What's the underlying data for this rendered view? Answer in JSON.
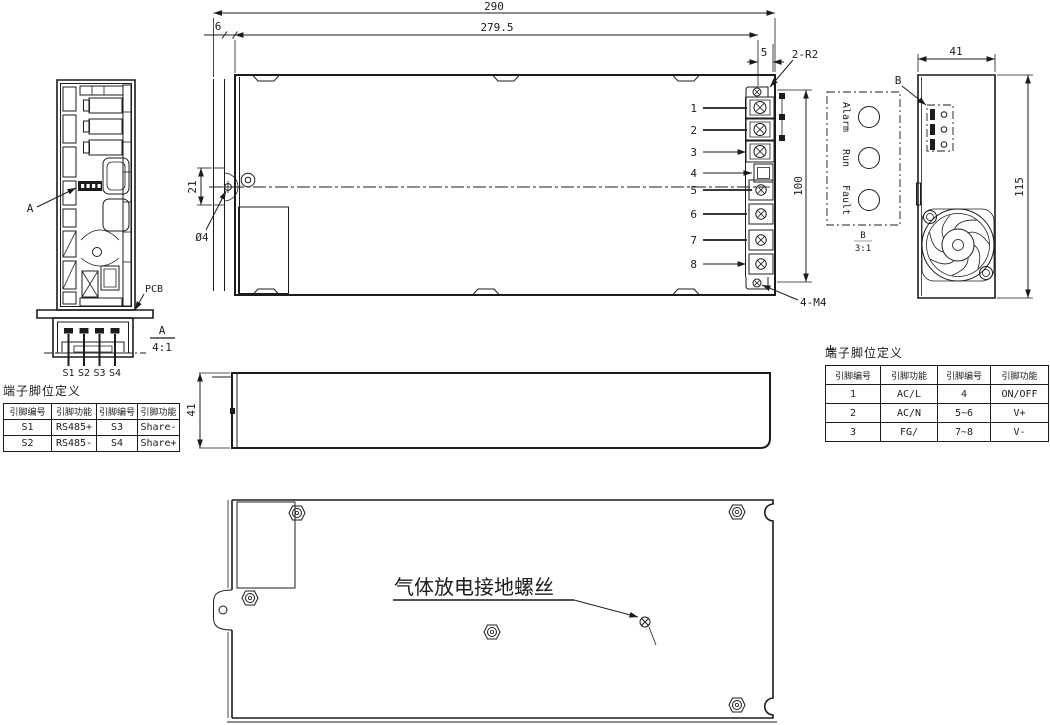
{
  "drawing": {
    "views": {
      "left_section": {
        "label_a": "A"
      },
      "connector_detail": {
        "pcb_label": "PCB",
        "name": "A",
        "scale": "4:1",
        "pins": [
          "S1",
          "S2",
          "S3",
          "S4"
        ]
      },
      "main": {
        "terminal_numbers": [
          "1",
          "2",
          "3",
          "4",
          "5",
          "6",
          "7",
          "8"
        ],
        "dims": {
          "overall_width": "290",
          "body_width": "279.5",
          "flange_offset": "6",
          "tab_width": "5",
          "corner_radius": "2-R2",
          "hole_offset": "21",
          "hole_dia": "Ø4",
          "terminal_span": "100",
          "mount_screws": "4-M4"
        }
      },
      "detail_b": {
        "ref_label": "B",
        "name": "B",
        "scale": "3:1",
        "indicators": [
          "Alarm",
          "Run",
          "Fault"
        ]
      },
      "end": {
        "dims": {
          "width": "41",
          "height": "115"
        }
      },
      "side": {
        "dims": {
          "depth": "41"
        }
      },
      "bottom": {
        "note": "气体放电接地螺丝"
      }
    },
    "tables": {
      "signal": {
        "title": "端子脚位定义",
        "headers": [
          "引脚编号",
          "引脚功能",
          "引脚编号",
          "引脚功能"
        ],
        "rows": [
          [
            "S1",
            "RS485+",
            "S3",
            "Share-"
          ],
          [
            "S2",
            "RS485-",
            "S4",
            "Share+"
          ]
        ]
      },
      "power": {
        "title": "端子脚位定义",
        "headers": [
          "引脚编号",
          "引脚功能",
          "引脚编号",
          "引脚功能"
        ],
        "rows": [
          [
            "1",
            "AC/L",
            "4",
            "ON/OFF"
          ],
          [
            "2",
            "AC/N",
            "5~6",
            "V+"
          ],
          [
            "3",
            "FG/",
            "7~8",
            "V-"
          ]
        ]
      }
    },
    "colors": {
      "detail_b_name": "#b97f7f",
      "detail_b_scale": "#8595c0",
      "line": "#1c1c1c"
    }
  }
}
